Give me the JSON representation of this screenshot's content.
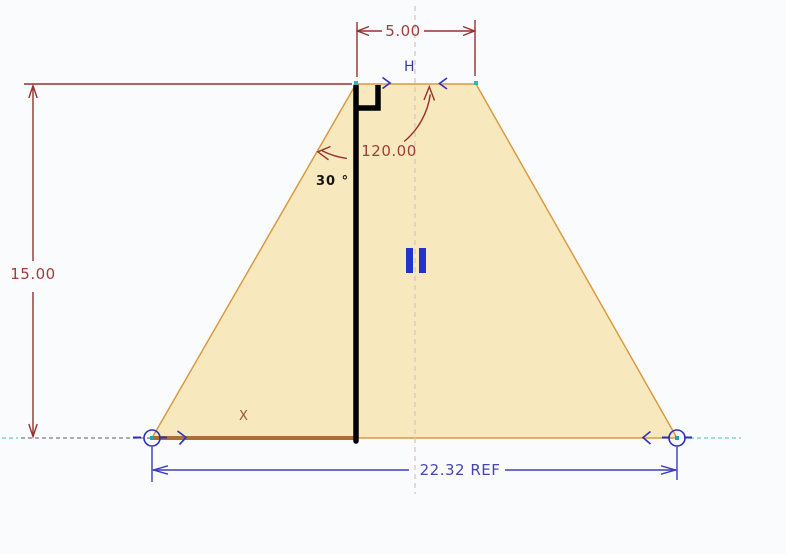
{
  "sketch": {
    "dimensions": {
      "top_width": {
        "value": "5.00"
      },
      "height": {
        "value": "15.00"
      },
      "angle": {
        "value": "120.00"
      },
      "angle_note": {
        "value": "30 °"
      },
      "base_width_ref": {
        "value": "22.32 REF"
      }
    },
    "labels": {
      "top_point": "H",
      "axis_x": "X"
    },
    "icons": {
      "perpendicular": "perpendicular-constraint-icon",
      "parallel_bars": "parallel-constraint-icon",
      "vertex_point": "vertex-point-icon",
      "endpoint_circle": "endpoint-circle-icon",
      "edge_chevron": "edge-direction-chevron-icon"
    },
    "colors": {
      "background": "#fafbfd",
      "fill": "#f7e8bd",
      "edge": "#d89b42",
      "thick_edge": "#a96f35",
      "dim_line": "#96312f",
      "dim_text": "#a13c3c",
      "blue": "#3c3cbe",
      "blue_text": "#4646ae",
      "teal": "#2aa3a0",
      "centerline": "#d8c6c6",
      "baseline_dash": "#8d948d",
      "baseline_dash_teal": "#86d2cf",
      "sketch_line": "#000000"
    }
  }
}
